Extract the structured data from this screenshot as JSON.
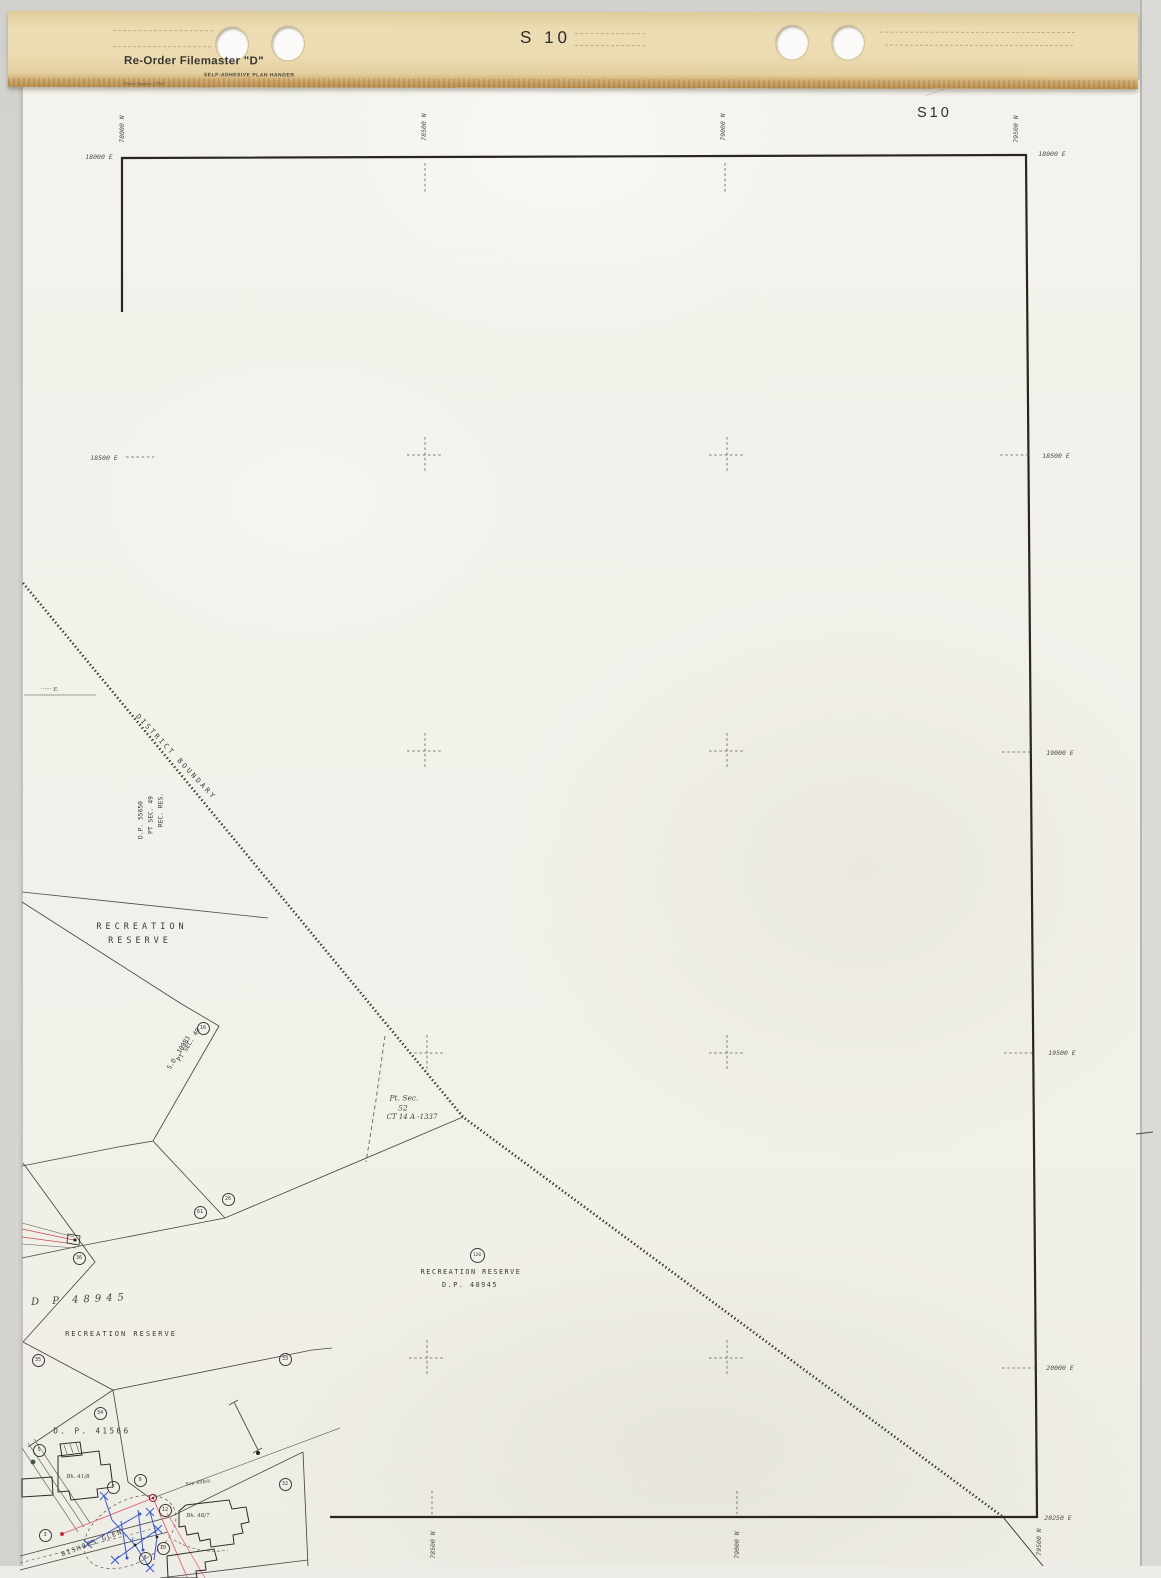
{
  "scene": {
    "background": "#d4d3cf",
    "sheet_color": "#f2f1ea",
    "ink": "#3b3934"
  },
  "hanger": {
    "product": "Re-Order Filemaster \"D\"",
    "subtitle": "SELF-ADHESIVE PLAN HANGER",
    "patent": "Patent Number 13784",
    "sheet_number": "S 10",
    "color": "#ead9b0"
  },
  "sheet": {
    "corner_label": "S10"
  },
  "map": {
    "texts": [
      {
        "name": "northing-top-78000",
        "text": "78000 N",
        "x": 122,
        "y": 129,
        "rot": -90,
        "cls": "g"
      },
      {
        "name": "northing-top-78500",
        "text": "78500 N",
        "x": 424,
        "y": 127,
        "rot": -90,
        "cls": "g"
      },
      {
        "name": "northing-top-79000",
        "text": "79000 N",
        "x": 723,
        "y": 127,
        "rot": -90,
        "cls": "g"
      },
      {
        "name": "northing-top-79500",
        "text": "79500 N",
        "x": 1016,
        "y": 129,
        "rot": -90,
        "cls": "g"
      },
      {
        "name": "easting-left-18000",
        "text": "18000 E",
        "x": 99,
        "y": 157,
        "cls": "g"
      },
      {
        "name": "easting-left-18500",
        "text": "18500 E",
        "x": 104,
        "y": 458,
        "cls": "g"
      },
      {
        "name": "easting-right-18000",
        "text": "18000 E",
        "x": 1052,
        "y": 154,
        "cls": "g"
      },
      {
        "name": "easting-right-18500",
        "text": "18500 E",
        "x": 1056,
        "y": 456,
        "cls": "g"
      },
      {
        "name": "easting-right-19000",
        "text": "19000 E",
        "x": 1060,
        "y": 753,
        "cls": "g"
      },
      {
        "name": "easting-right-19500",
        "text": "19500 E",
        "x": 1062,
        "y": 1053,
        "cls": "g"
      },
      {
        "name": "easting-right-20000",
        "text": "20000 E",
        "x": 1060,
        "y": 1368,
        "cls": "g"
      },
      {
        "name": "easting-right-20250",
        "text": "20250 E",
        "x": 1058,
        "y": 1518,
        "cls": "g"
      },
      {
        "name": "northing-bottom-78500",
        "text": "78500 N",
        "x": 433,
        "y": 1545,
        "rot": -90,
        "cls": "g"
      },
      {
        "name": "northing-bottom-79000",
        "text": "79000 N",
        "x": 737,
        "y": 1545,
        "rot": -90,
        "cls": "g"
      },
      {
        "name": "northing-bottom-79500",
        "text": "79500 N",
        "x": 1039,
        "y": 1542,
        "rot": -90,
        "cls": "g"
      },
      {
        "name": "district-boundary-label",
        "text": "DISTRICT BOUNDARY",
        "x": 176,
        "y": 757,
        "rot": 47,
        "fs": 7,
        "ls": 2.5
      },
      {
        "name": "rec-res-line1",
        "text": "REC. RES.",
        "x": 161,
        "y": 810,
        "rot": -90,
        "fs": 6.3
      },
      {
        "name": "rec-res-line2",
        "text": "PT SEC. 49",
        "x": 151,
        "y": 815,
        "rot": -90,
        "fs": 6.3
      },
      {
        "name": "rec-res-line3",
        "text": "D.P. 55650",
        "x": 141,
        "y": 820,
        "rot": -90,
        "fs": 6.3
      },
      {
        "name": "recreation-reserve-upper-1",
        "text": "RECREATION",
        "x": 142,
        "y": 927,
        "fs": 8.5,
        "ls": 4
      },
      {
        "name": "recreation-reserve-upper-2",
        "text": "RESERVE",
        "x": 140,
        "y": 941,
        "fs": 8.5,
        "ls": 4
      },
      {
        "name": "pt-sec-49-so10983-1",
        "text": "PT SEC. 49",
        "x": 189,
        "y": 1045,
        "rot": -58,
        "fs": 6.3
      },
      {
        "name": "pt-sec-49-so10983-2",
        "text": "S.O. 10983",
        "x": 179,
        "y": 1053,
        "rot": -58,
        "fs": 6.3
      },
      {
        "name": "pt-sec-52-line1",
        "text": "Pt. Sec.",
        "x": 404,
        "y": 1098,
        "fs": 7.5,
        "cls": "hand"
      },
      {
        "name": "pt-sec-52-line2",
        "text": "52",
        "x": 403,
        "y": 1108,
        "fs": 7.5,
        "cls": "hand"
      },
      {
        "name": "pt-sec-52-line3",
        "text": "CT 14 A -1337",
        "x": 412,
        "y": 1117,
        "fs": 7,
        "cls": "hand"
      },
      {
        "name": "recreation-reserve-center-1",
        "text": "RECREATION RESERVE",
        "x": 471,
        "y": 1272,
        "fs": 6.8,
        "ls": 1.5
      },
      {
        "name": "recreation-reserve-center-2",
        "text": "D.P. 48945",
        "x": 470,
        "y": 1285,
        "fs": 6.8,
        "ls": 1.5
      },
      {
        "name": "dp-48945-hand",
        "text": "D P 48945",
        "x": 80,
        "y": 1300,
        "fs": 10,
        "ls": 5,
        "rot": -3,
        "cls": "hand"
      },
      {
        "name": "recreation-reserve-lower",
        "text": "RECREATION RESERVE",
        "x": 121,
        "y": 1334,
        "fs": 7,
        "ls": 2
      },
      {
        "name": "dp-41566",
        "text": "D. P.  41566",
        "x": 92,
        "y": 1431,
        "fs": 7.5,
        "ls": 2.5
      },
      {
        "name": "bk-41-8",
        "text": "Bk. 41/8",
        "x": 78,
        "y": 1477,
        "fs": 5.5,
        "cls": "hand"
      },
      {
        "name": "bk-48-7",
        "text": "Bk. 48/7",
        "x": 198,
        "y": 1516,
        "fs": 5.5,
        "cls": "hand"
      },
      {
        "name": "see-49b-a",
        "text": "See 49b/a",
        "x": 198,
        "y": 1483,
        "rot": -9,
        "fs": 5,
        "cls": "hand"
      },
      {
        "name": "bishops-glen",
        "text": "BISHOPS GLEN",
        "x": 92,
        "y": 1543,
        "rot": -21,
        "fs": 6.5,
        "ls": 1.5
      },
      {
        "name": "left-edge-note",
        "text": "······ E.",
        "x": 50,
        "y": 690,
        "fs": 5.5,
        "cls": "hand"
      },
      {
        "name": "blue-dim-note",
        "text": "4'",
        "x": 133,
        "y": 1540,
        "fs": 5,
        "cls": "hand",
        "color": "#3a57c9"
      }
    ],
    "circles": [
      {
        "n": "16",
        "x": 203,
        "y": 1028
      },
      {
        "n": "120",
        "x": 477,
        "y": 1255,
        "d": 15
      },
      {
        "n": "36",
        "x": 79,
        "y": 1258
      },
      {
        "n": "61",
        "x": 200,
        "y": 1212
      },
      {
        "n": "26",
        "x": 228,
        "y": 1199
      },
      {
        "n": "35",
        "x": 38,
        "y": 1360
      },
      {
        "n": "33",
        "x": 285,
        "y": 1359
      },
      {
        "n": "34",
        "x": 100,
        "y": 1413
      },
      {
        "n": "5",
        "x": 39,
        "y": 1450
      },
      {
        "n": "9",
        "x": 140,
        "y": 1480
      },
      {
        "n": "7",
        "x": 113,
        "y": 1487
      },
      {
        "n": "3",
        "x": 45,
        "y": 1535
      },
      {
        "n": "12",
        "x": 165,
        "y": 1510
      },
      {
        "n": "32",
        "x": 285,
        "y": 1484
      },
      {
        "n": "10",
        "x": 163,
        "y": 1548
      },
      {
        "n": "8",
        "x": 145,
        "y": 1558
      }
    ],
    "grid": {
      "crosses": [
        [
          425,
          455
        ],
        [
          727,
          455
        ],
        [
          425,
          751
        ],
        [
          727,
          751
        ],
        [
          427,
          1053
        ],
        [
          727,
          1053
        ],
        [
          427,
          1358
        ],
        [
          727,
          1358
        ]
      ],
      "ticks": [
        [
          126,
          457,
          154,
          457
        ],
        [
          425,
          163,
          425,
          192
        ],
        [
          725,
          163,
          725,
          192
        ],
        [
          1000,
          455,
          1030,
          455
        ],
        [
          1002,
          752,
          1032,
          752
        ],
        [
          1004,
          1053,
          1034,
          1053
        ],
        [
          1002,
          1368,
          1034,
          1368
        ],
        [
          432,
          1491,
          432,
          1514
        ],
        [
          737,
          1491,
          737,
          1514
        ]
      ]
    }
  }
}
